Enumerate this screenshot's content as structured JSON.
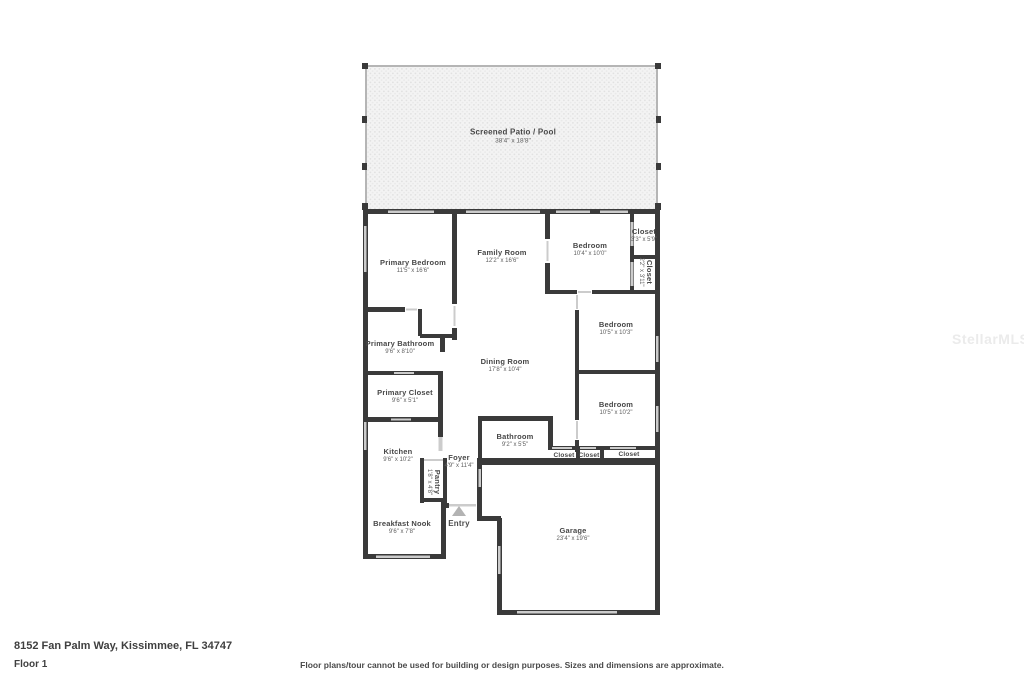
{
  "title": "Floor plan",
  "colors": {
    "wall": "#3a3a3a",
    "opening": "#cccccc",
    "patio_border": "#b5b5b5",
    "patio_fill": "#f3f3f3",
    "patio_dot": "#e1e1e1",
    "entry_arrow": "#b3b3b3",
    "label_text": "#474747",
    "dims_text": "#5f5f5f"
  },
  "icons": {
    "entry_arrow": "triangle-up"
  },
  "rooms": [
    {
      "name": "Screened Patio / Pool",
      "dims": "38'4\" x 18'8\""
    },
    {
      "name": "Primary Bedroom",
      "dims": "11'5\" x 16'6\""
    },
    {
      "name": "Family Room",
      "dims": "12'2\" x 16'6\""
    },
    {
      "name": "Bedroom",
      "dims": "10'4\" x 10'0\""
    },
    {
      "name": "Closet",
      "dims": "3'3\" x 5'9\""
    },
    {
      "name": "Closet",
      "dims": "2'2\" x 3'11\""
    },
    {
      "name": "Primary Bathroom",
      "dims": "9'6\" x 8'10\""
    },
    {
      "name": "Dining Room",
      "dims": "17'8\" x 10'4\""
    },
    {
      "name": "Bedroom",
      "dims": "10'5\" x 10'3\""
    },
    {
      "name": "Bedroom",
      "dims": "10'5\" x 10'2\""
    },
    {
      "name": "Primary Closet",
      "dims": "9'6\" x 5'1\""
    },
    {
      "name": "Kitchen",
      "dims": "9'6\" x 10'2\""
    },
    {
      "name": "Bathroom",
      "dims": "9'2\" x 5'5\""
    },
    {
      "name": "Foyer",
      "dims": "4'9\" x 11'4\""
    },
    {
      "name": "Pantry",
      "dims": "1'8\" x 4'8\""
    },
    {
      "name": "Closet",
      "dims": ""
    },
    {
      "name": "Closet",
      "dims": ""
    },
    {
      "name": "Closet",
      "dims": ""
    },
    {
      "name": "Breakfast Nook",
      "dims": "9'6\" x 7'8\""
    },
    {
      "name": "Garage",
      "dims": "23'4\" x 19'6\""
    },
    {
      "name": "Entry",
      "dims": ""
    }
  ],
  "footer": {
    "address": "8152 Fan Palm Way, Kissimmee, FL 34747",
    "floor_label": "Floor 1",
    "disclaimer": "Floor plans/tour cannot be used for building or design purposes. Sizes and dimensions are approximate."
  },
  "watermark": {
    "text": "StellarMLS"
  }
}
